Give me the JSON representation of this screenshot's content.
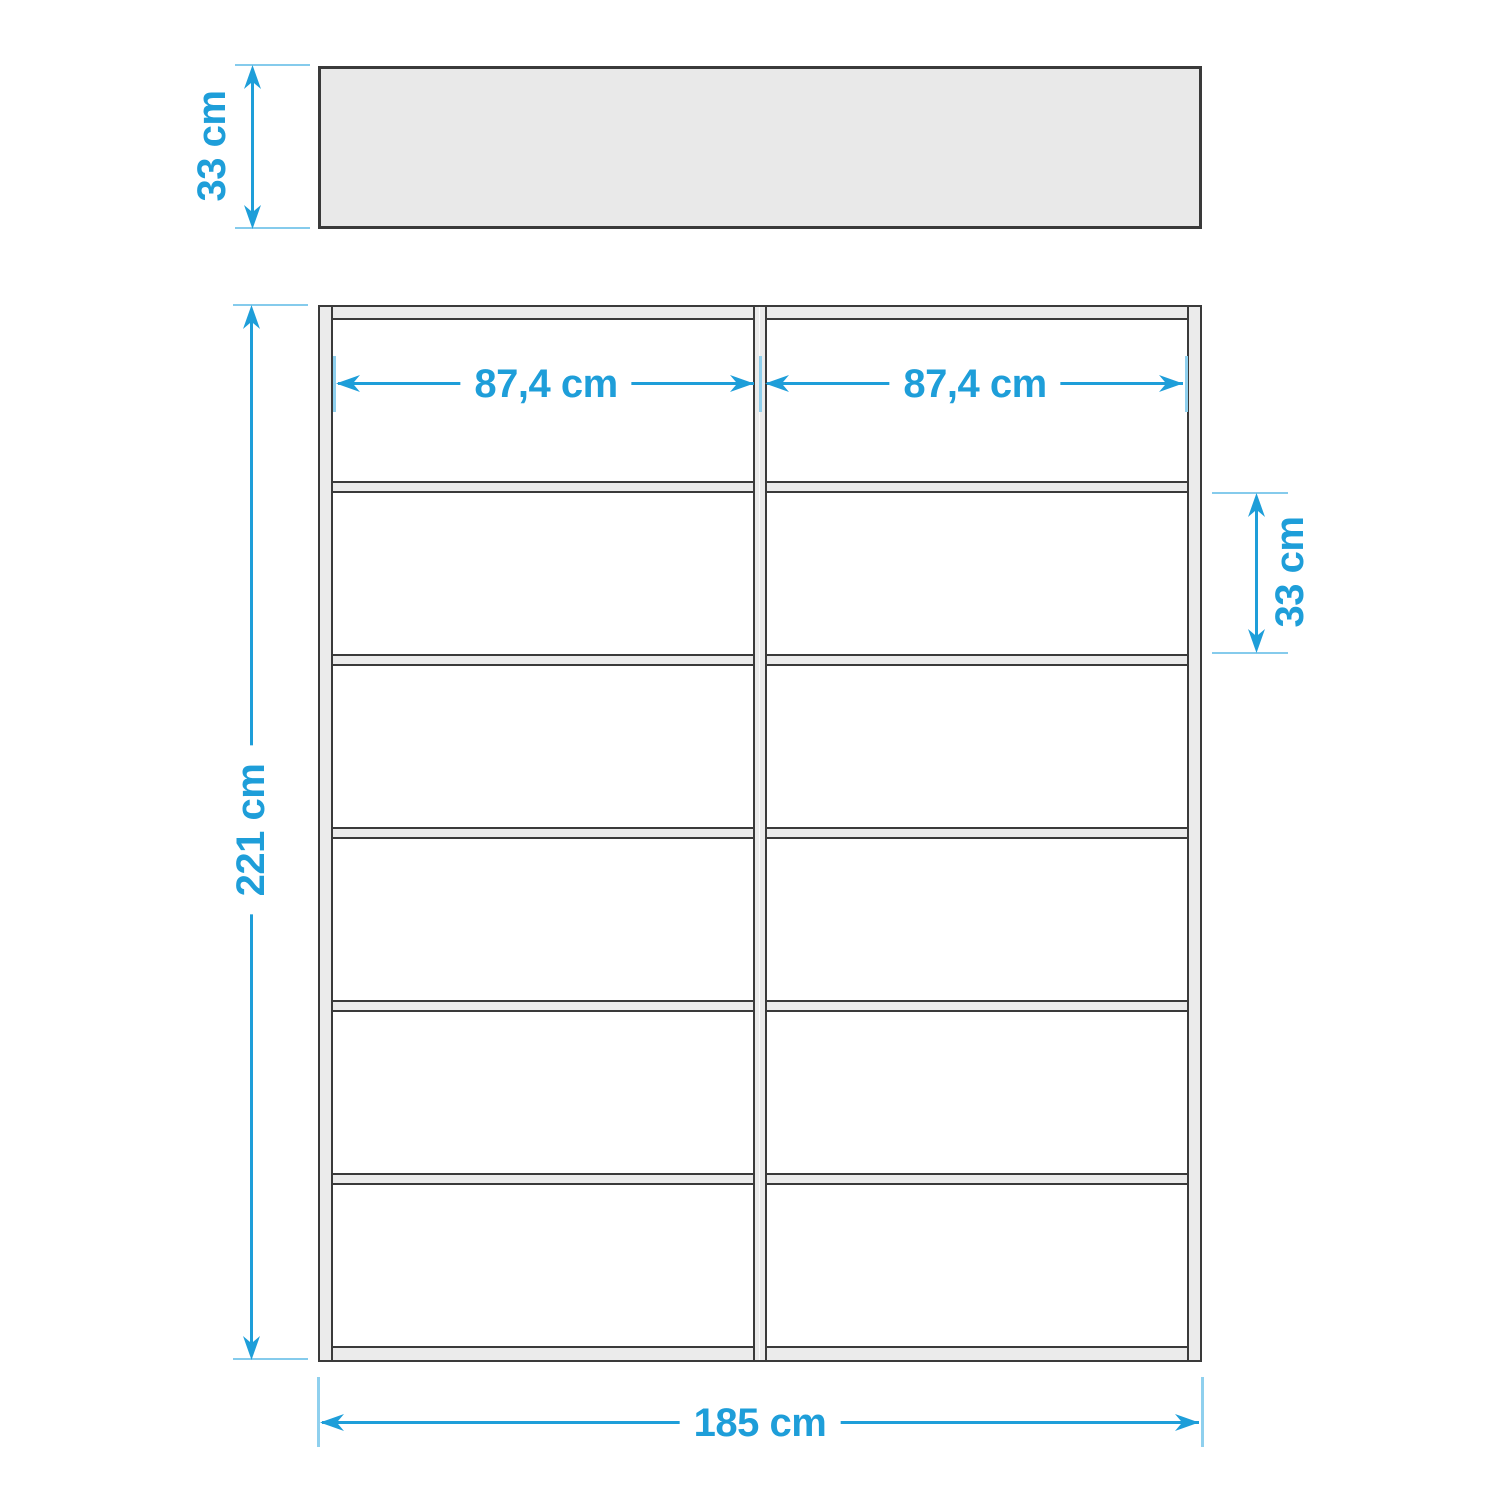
{
  "diagram": {
    "title": "Shelf unit dimension drawing",
    "views": {
      "plan_view": {
        "description": "top view of shelf, gray slab",
        "depth_label": "33 cm"
      },
      "front_view": {
        "columns": 2,
        "rows": 6,
        "total_height_label": "221 cm",
        "total_width_label": "185 cm",
        "compartment_width_left_label": "87,4 cm",
        "compartment_width_right_label": "87,4 cm",
        "compartment_height_label": "33 cm"
      }
    },
    "colors": {
      "dimension_blue": "#1e9ed9",
      "extension_light_blue": "#85cbec",
      "panel_gray": "#ebebeb",
      "outline_dark": "#3a3a3a",
      "background": "#ffffff"
    }
  }
}
